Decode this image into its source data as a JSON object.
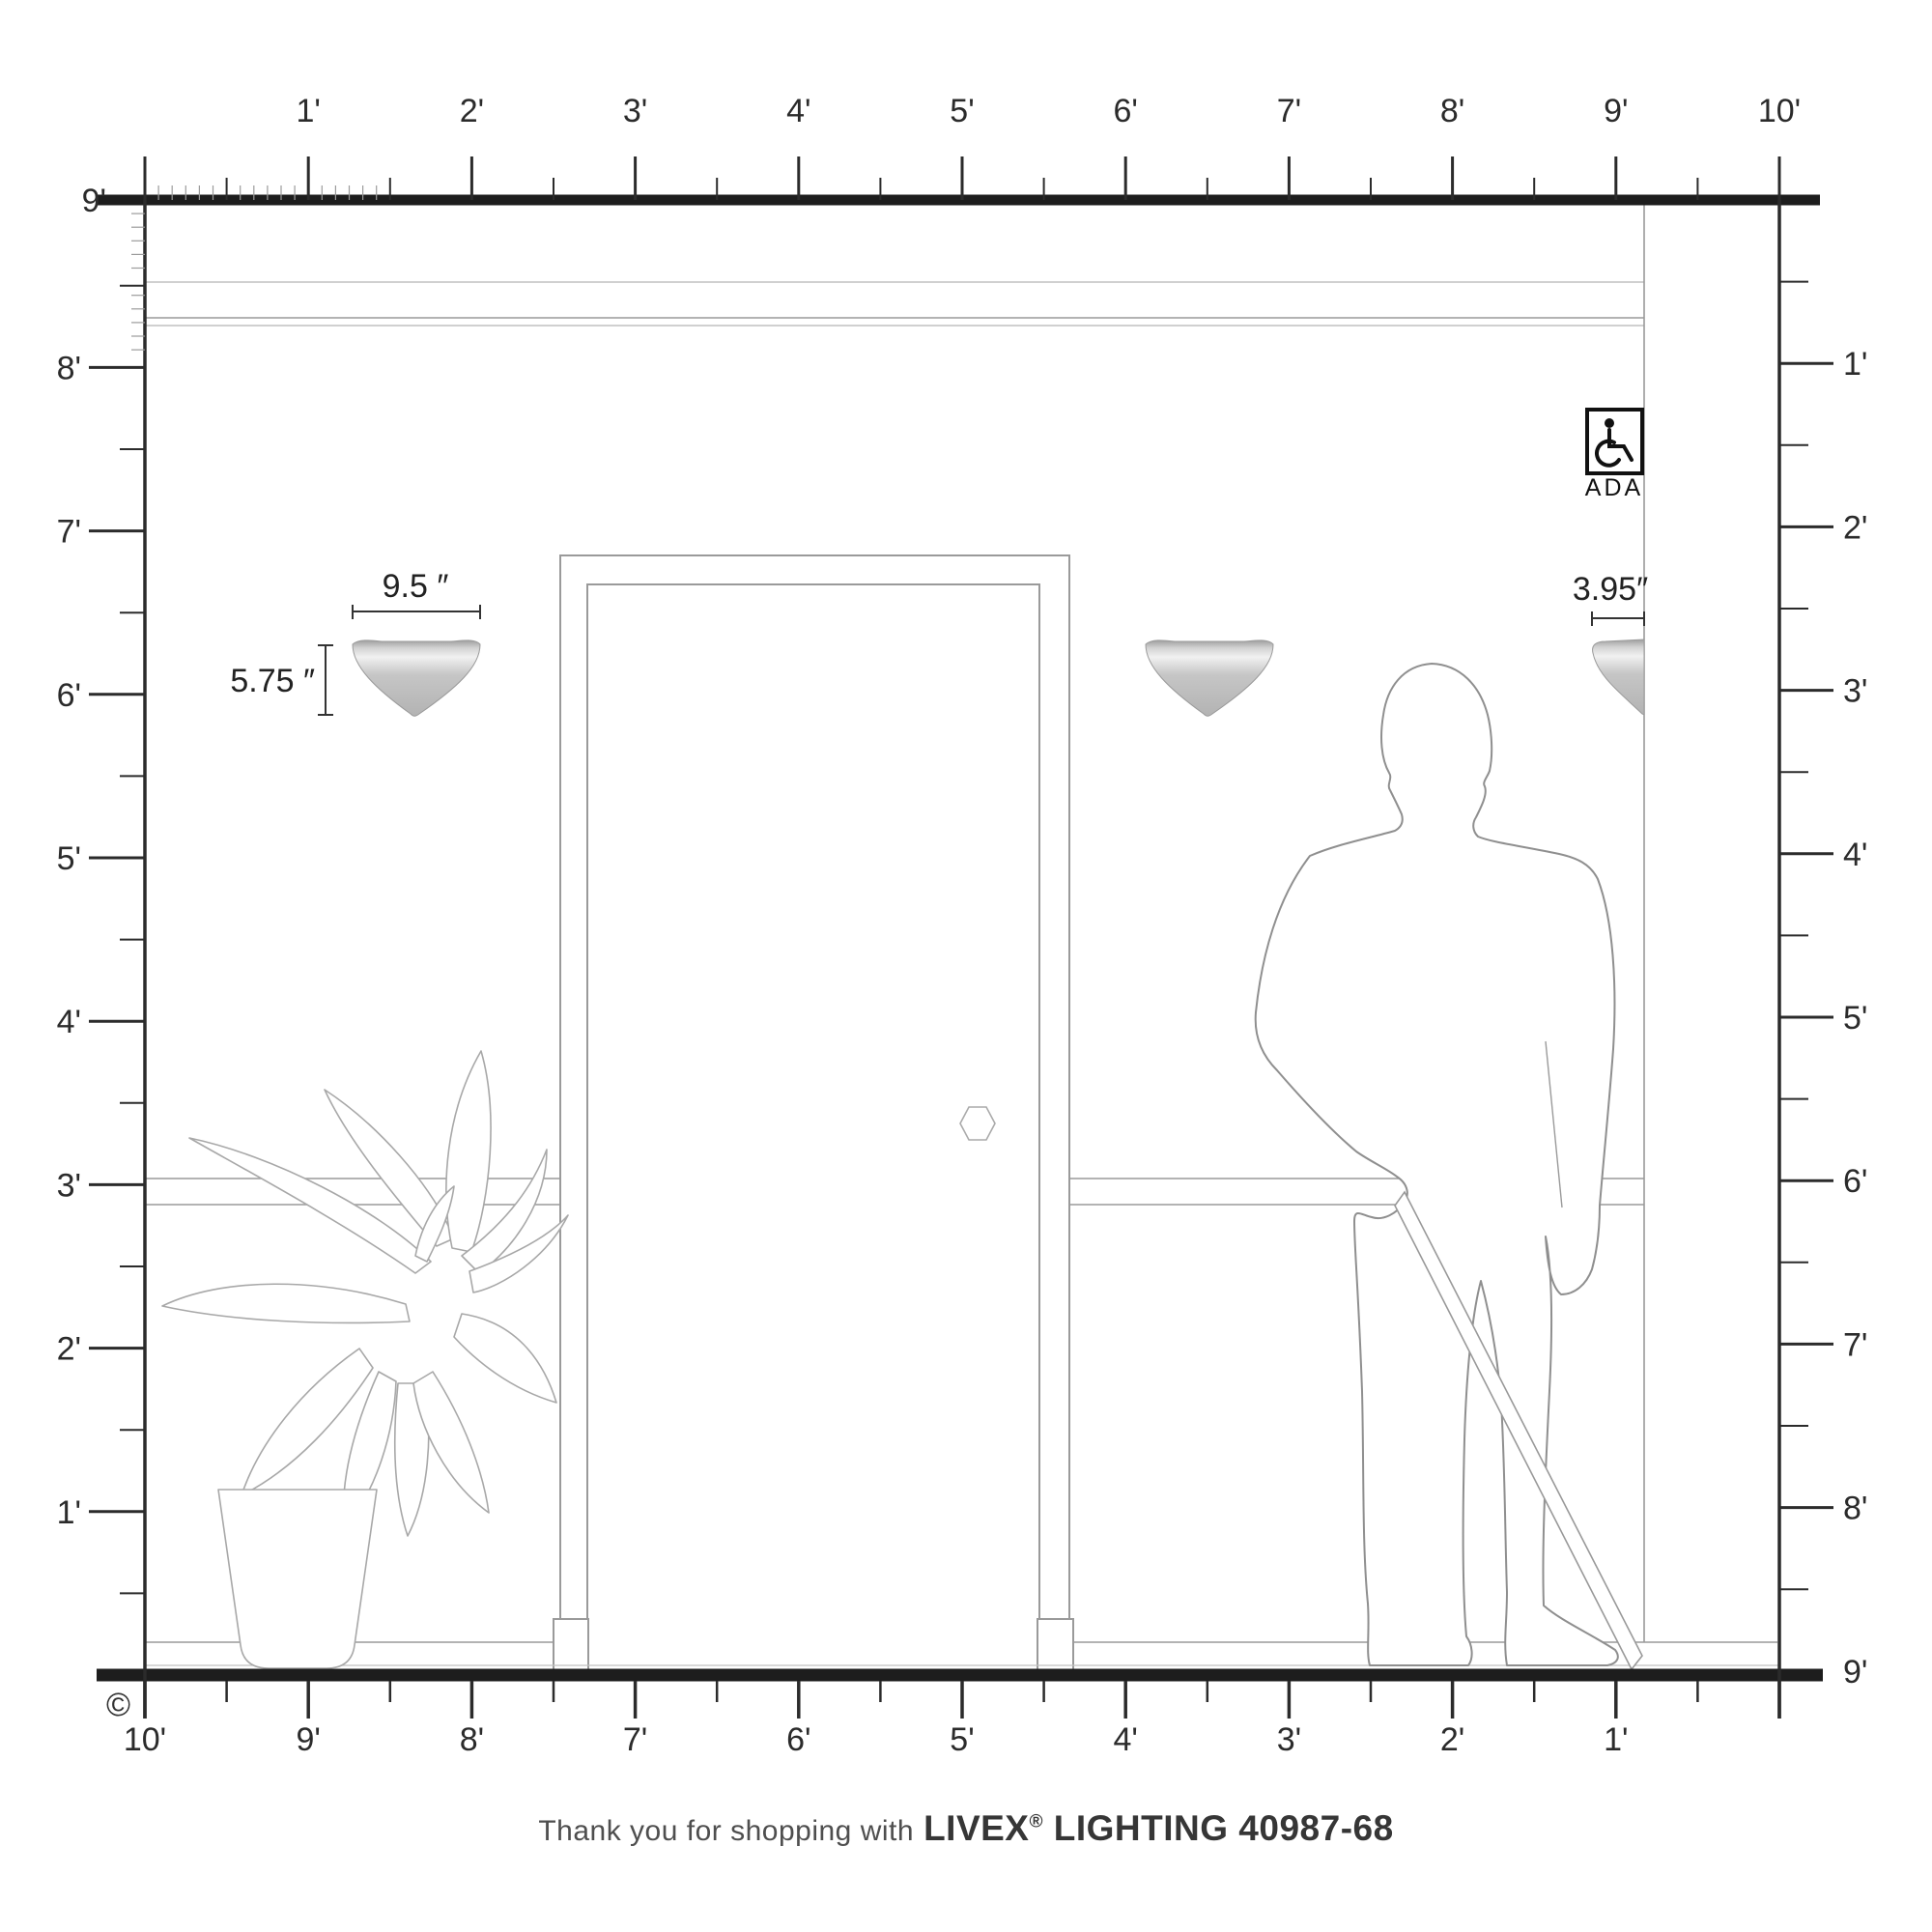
{
  "rulers": {
    "top": {
      "labels": [
        "1'",
        "2'",
        "3'",
        "4'",
        "5'",
        "6'",
        "7'",
        "8'",
        "9'",
        "10'"
      ]
    },
    "left": {
      "labels": [
        "9'",
        "8'",
        "7'",
        "6'",
        "5'",
        "4'",
        "3'",
        "2'",
        "1'"
      ]
    },
    "right": {
      "labels": [
        "1'",
        "2'",
        "3'",
        "4'",
        "5'",
        "6'",
        "7'",
        "8'",
        "9'"
      ]
    },
    "bottom": {
      "labels": [
        "10'",
        "9'",
        "8'",
        "7'",
        "6'",
        "5'",
        "4'",
        "3'",
        "2'",
        "1'"
      ]
    }
  },
  "fixture": {
    "width_label": "9.5 ″",
    "height_label": "5.75 ″",
    "depth_label": "3.95″"
  },
  "ada_badge": {
    "label": "ADA",
    "icon": "wheelchair-icon"
  },
  "copyright_symbol": "©",
  "footer": {
    "prefix": "Thank you for shopping with",
    "brand": "LIVEX",
    "registered": "®",
    "suffix": "LIGHTING 40987-68"
  },
  "colors": {
    "ruler": "#2b2b2b",
    "wall_lines": "#9a9a9a",
    "sconce_gray": "#bfbfbf",
    "background": "#ffffff"
  }
}
